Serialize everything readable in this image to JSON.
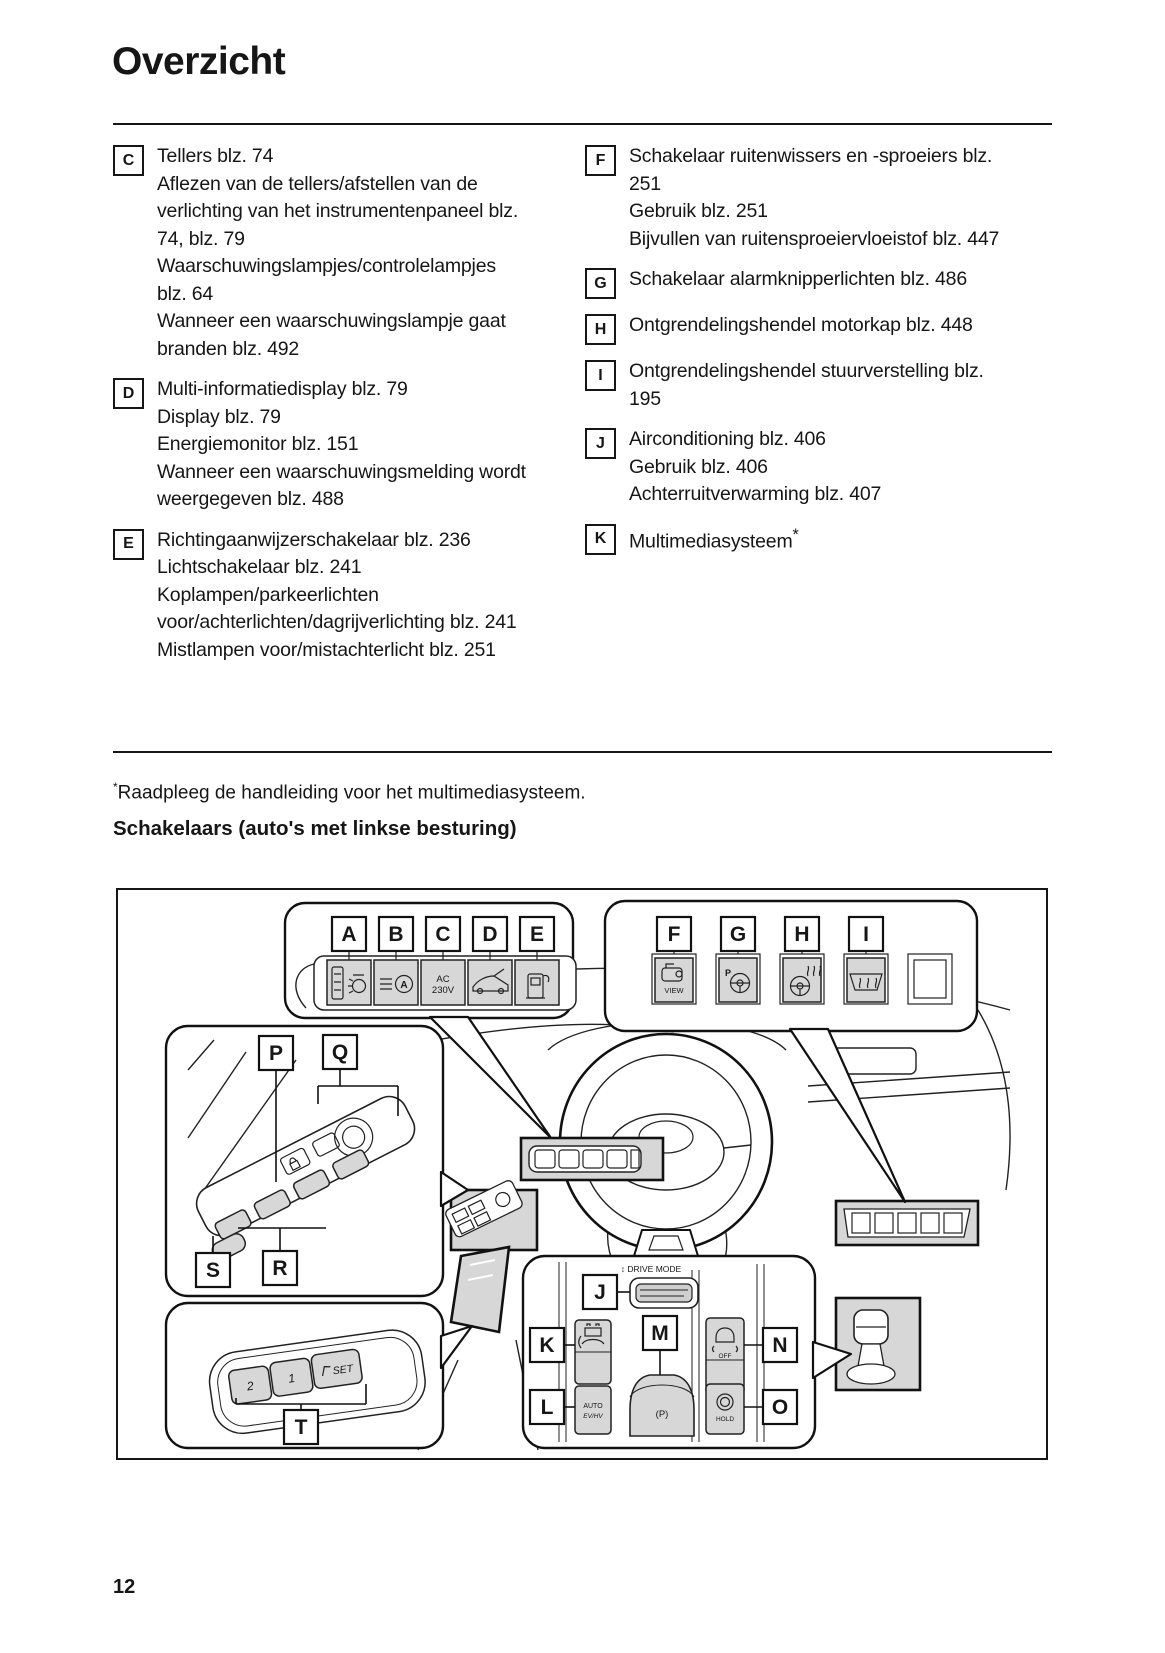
{
  "page": {
    "title": "Overzicht",
    "number": "12"
  },
  "footnote": {
    "marker": "*",
    "text": "Raadpleeg de handleiding voor het multimediasysteem."
  },
  "subheading": "Schakelaars (auto's met linkse besturing)",
  "overview": {
    "left": [
      {
        "letter": "C",
        "lines": [
          "Tellers blz. 74",
          "Aflezen van de tellers/afstellen van de verlichting van het instrumentenpaneel blz. 74, blz. 79",
          "Waarschuwingslampjes/controlelampjes blz. 64",
          "Wanneer een waarschuwingslampje gaat branden blz. 492"
        ]
      },
      {
        "letter": "D",
        "lines": [
          "Multi-informatiedisplay blz. 79",
          "Display blz. 79",
          "Energiemonitor blz. 151",
          "Wanneer een waarschuwingsmelding wordt weergegeven blz. 488"
        ]
      },
      {
        "letter": "E",
        "lines": [
          "Richtingaanwijzerschakelaar blz. 236",
          "Lichtschakelaar blz. 241",
          "Koplampen/parkeerlichten voor/achterlichten/dagrijverlichting blz. 241",
          "Mistlampen voor/mistachterlicht blz. 251"
        ]
      }
    ],
    "right": [
      {
        "letter": "F",
        "lines": [
          "Schakelaar ruitenwissers en -sproeiers blz. 251",
          "Gebruik blz. 251",
          "Bijvullen van ruitensproeiervloeistof blz. 447"
        ]
      },
      {
        "letter": "G",
        "lines": [
          "Schakelaar alarmknipperlichten blz. 486"
        ]
      },
      {
        "letter": "H",
        "lines": [
          "Ontgrendelingshendel motorkap blz. 448"
        ]
      },
      {
        "letter": "I",
        "lines": [
          "Ontgrendelingshendel stuurverstelling blz. 195"
        ]
      },
      {
        "letter": "J",
        "lines": [
          "Airconditioning blz. 406",
          "Gebruik blz. 406",
          "Achterruitverwarming blz. 407"
        ]
      },
      {
        "letter": "K",
        "lines": [
          "Multimediasysteem"
        ],
        "sup": "*"
      }
    ]
  },
  "diagram": {
    "colors": {
      "ink": "#161616",
      "highlight_fill": "#d7d7d7"
    },
    "callouts": {
      "a": "A",
      "b": "B",
      "c": "C",
      "d": "D",
      "e": "E",
      "f": "F",
      "g": "G",
      "h": "H",
      "i": "I",
      "j": "J",
      "k": "K",
      "l": "L",
      "m": "M",
      "n": "N",
      "o": "O",
      "p": "P",
      "q": "Q",
      "r": "R",
      "s": "S",
      "t": "T"
    },
    "texts": {
      "drive_mode": "↕ DRIVE MODE",
      "view": "VIEW",
      "ac_top": "AC",
      "ac_bottom": "230V",
      "auto": "AUTO",
      "evhv": "EV/HV",
      "park_brake": "(P)",
      "off": "OFF",
      "hold": "HOLD",
      "p": "P",
      "a_badge": "A",
      "seat_mem_2": "2",
      "seat_mem_1": "1",
      "seat_mem_set": "SET"
    }
  }
}
